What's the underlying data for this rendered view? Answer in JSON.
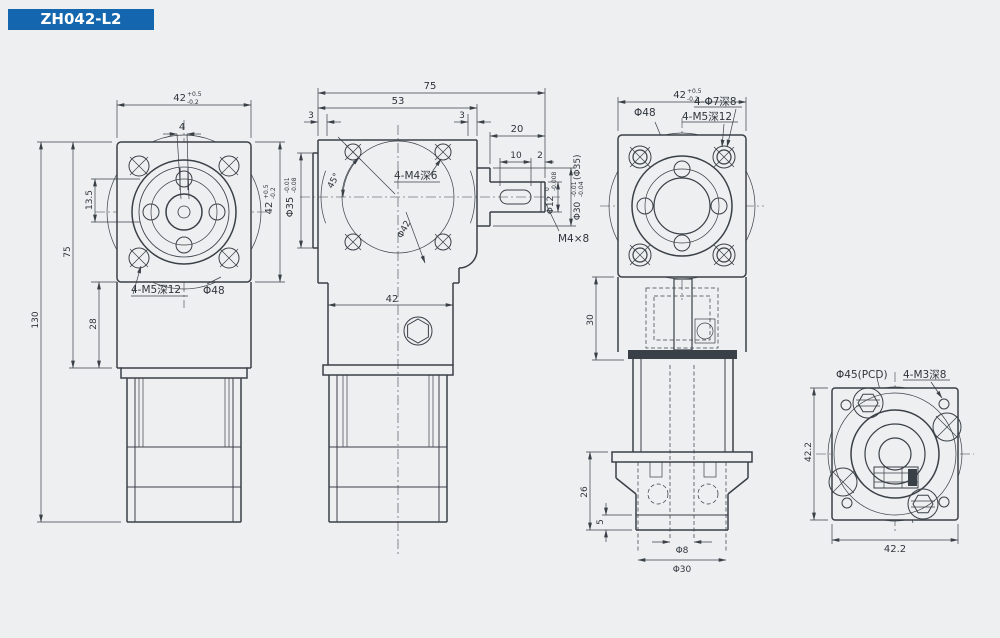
{
  "title": "ZH042-L2",
  "colors": {
    "accent": "#1467ae",
    "line": "#3a4047",
    "background": "#edeff1"
  },
  "views": {
    "front": {
      "width_main": "42",
      "width_sup": "+0.5",
      "width_sub": "-0.2",
      "keyway": "4",
      "offset": "13.5",
      "body_height": "75",
      "total_height": "130",
      "section_height": "28",
      "height_main": "42",
      "height_sup": "+0.5",
      "height_sub": "-0.2",
      "tapped_holes": "4-M5深12",
      "boss": "Φ48"
    },
    "side": {
      "total_length": "75",
      "housing_length": "53",
      "edge_left": "3",
      "edge_right": "3",
      "shaft_length": "20",
      "key_length": "10",
      "key_offset": "2",
      "hole_angle": "45°",
      "tapped_holes": "4-M4深6",
      "bolt_circle": "Φ42",
      "pilot_main": "Φ35",
      "pilot_sup": "-0.01",
      "pilot_sub": "-0.08",
      "shaft_main": "Φ12",
      "shaft_sup": "0",
      "shaft_sub": "-0.008",
      "hub_main": "Φ30",
      "hub_sup": "-0.01",
      "hub_sub": "-0.04",
      "hub_note": "(Φ35)",
      "key_spec": "M4×8",
      "leg_width": "42"
    },
    "back": {
      "width_main": "42",
      "width_sup": "+0.5",
      "width_sub": "-0.2",
      "boss": "Φ48",
      "cbore_holes": "4-Φ7深8",
      "tapped_holes": "4-M5深12",
      "cavity_height": "30",
      "motor_height": "26",
      "step": "5",
      "bore": "Φ8",
      "hub": "Φ30"
    },
    "output": {
      "pcd": "Φ45(PCD)",
      "tapped_holes": "4-M3深8",
      "height": "42.2",
      "width": "42.2"
    }
  }
}
